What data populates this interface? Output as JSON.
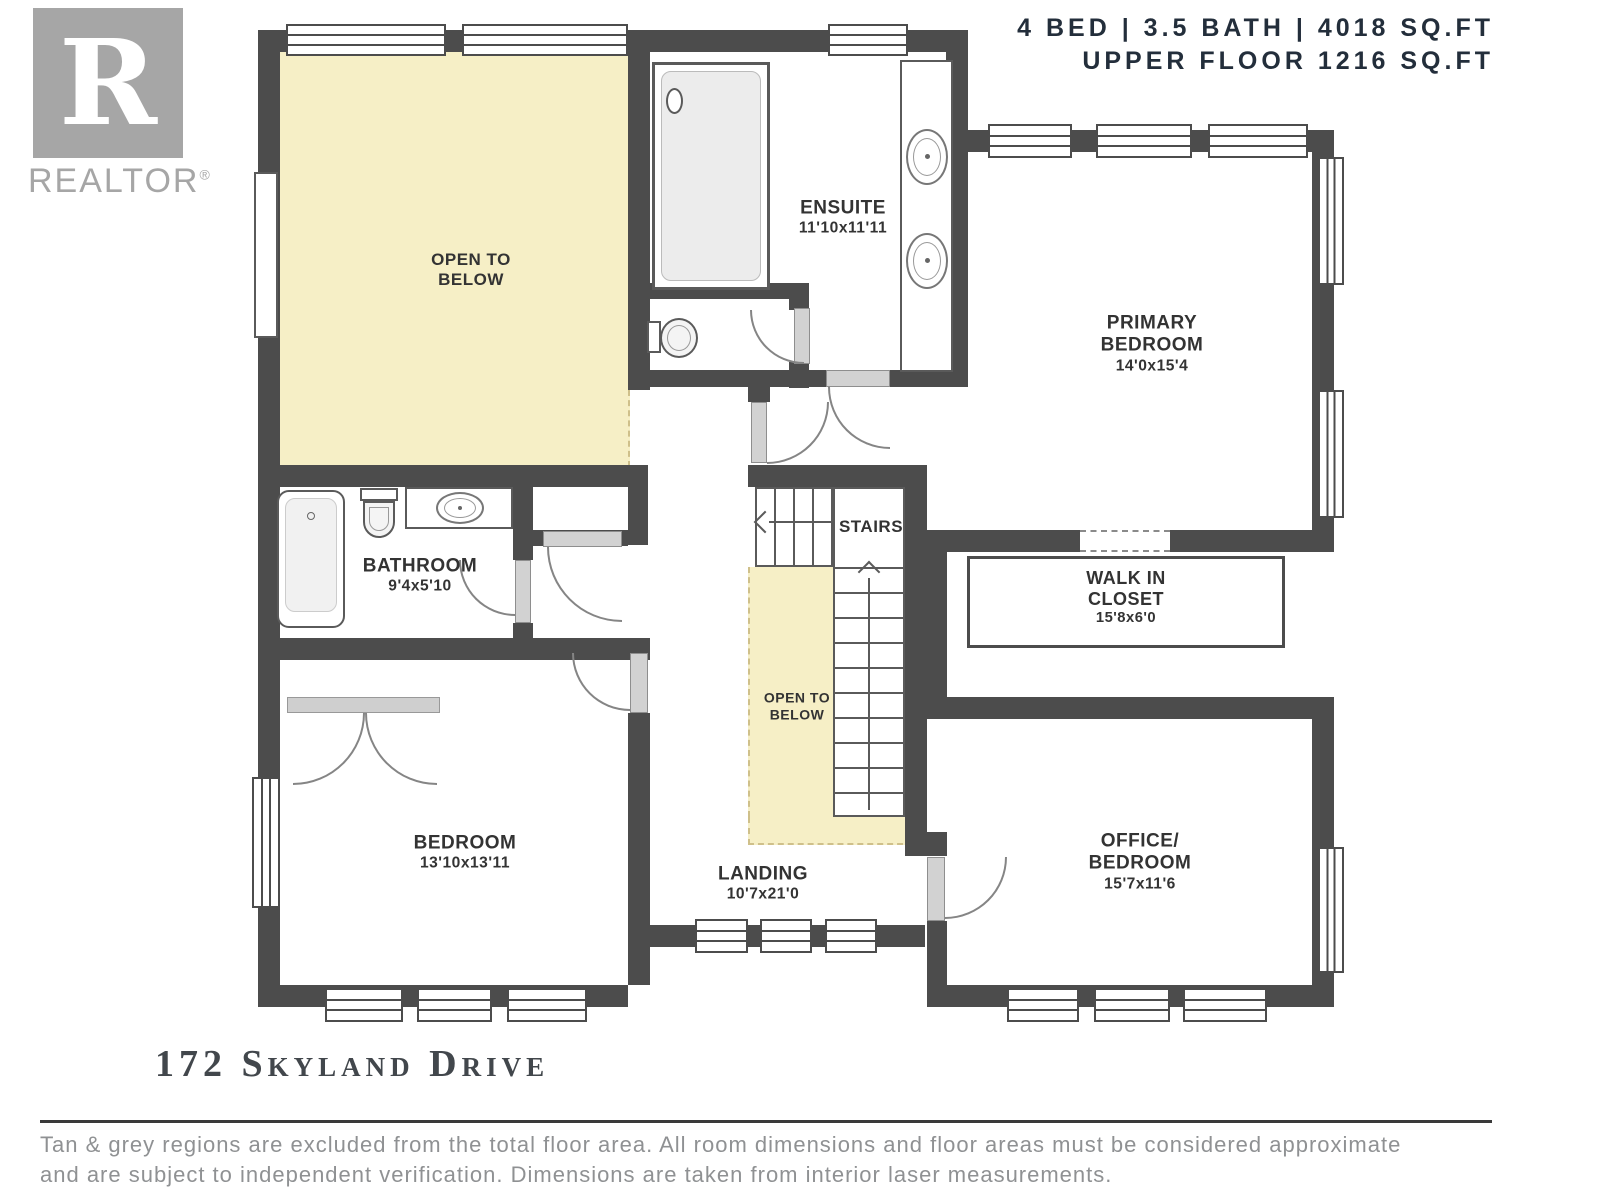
{
  "header": {
    "line1": "4 BED | 3.5 BATH | 4018 SQ.FT",
    "line2": "UPPER FLOOR 1216 SQ.FT"
  },
  "logo": {
    "letter": "R",
    "brand": "REALTOR",
    "reg": "®"
  },
  "rooms": [
    {
      "id": "open-to-below-main",
      "lines": [
        "OPEN TO",
        "BELOW"
      ]
    },
    {
      "id": "ensuite",
      "lines": [
        "ENSUITE",
        "11'10x11'11"
      ]
    },
    {
      "id": "primary-bedroom",
      "lines": [
        "PRIMARY",
        "BEDROOM",
        "14'0x15'4"
      ]
    },
    {
      "id": "bathroom",
      "lines": [
        "BATHROOM",
        "9'4x5'10"
      ]
    },
    {
      "id": "stairs",
      "lines": [
        "STAIRS"
      ]
    },
    {
      "id": "walk-in-closet",
      "lines": [
        "WALK IN",
        "CLOSET",
        "15'8x6'0"
      ]
    },
    {
      "id": "open-to-below-stairs",
      "lines": [
        "OPEN TO",
        "BELOW"
      ]
    },
    {
      "id": "bedroom",
      "lines": [
        "BEDROOM",
        "13'10x13'11"
      ]
    },
    {
      "id": "landing",
      "lines": [
        "LANDING",
        "10'7x21'0"
      ]
    },
    {
      "id": "office-bedroom",
      "lines": [
        "OFFICE/",
        "BEDROOM",
        "15'7x11'6"
      ]
    }
  ],
  "footer": {
    "title": "172 Skyland Drive",
    "disclaimer1": "Tan & grey regions are excluded from the total floor area. All room dimensions and floor areas must be considered approximate",
    "disclaimer2": "and are subject to independent verification. Dimensions are taken from interior laser measurements."
  },
  "colors": {
    "wall": "#4c4c4c",
    "highlight": "#f6efc6",
    "header_text": "#232e3b",
    "label_text": "#333333",
    "logo_gray": "#a6a6a6",
    "disclaimer_gray": "#8f9193"
  }
}
